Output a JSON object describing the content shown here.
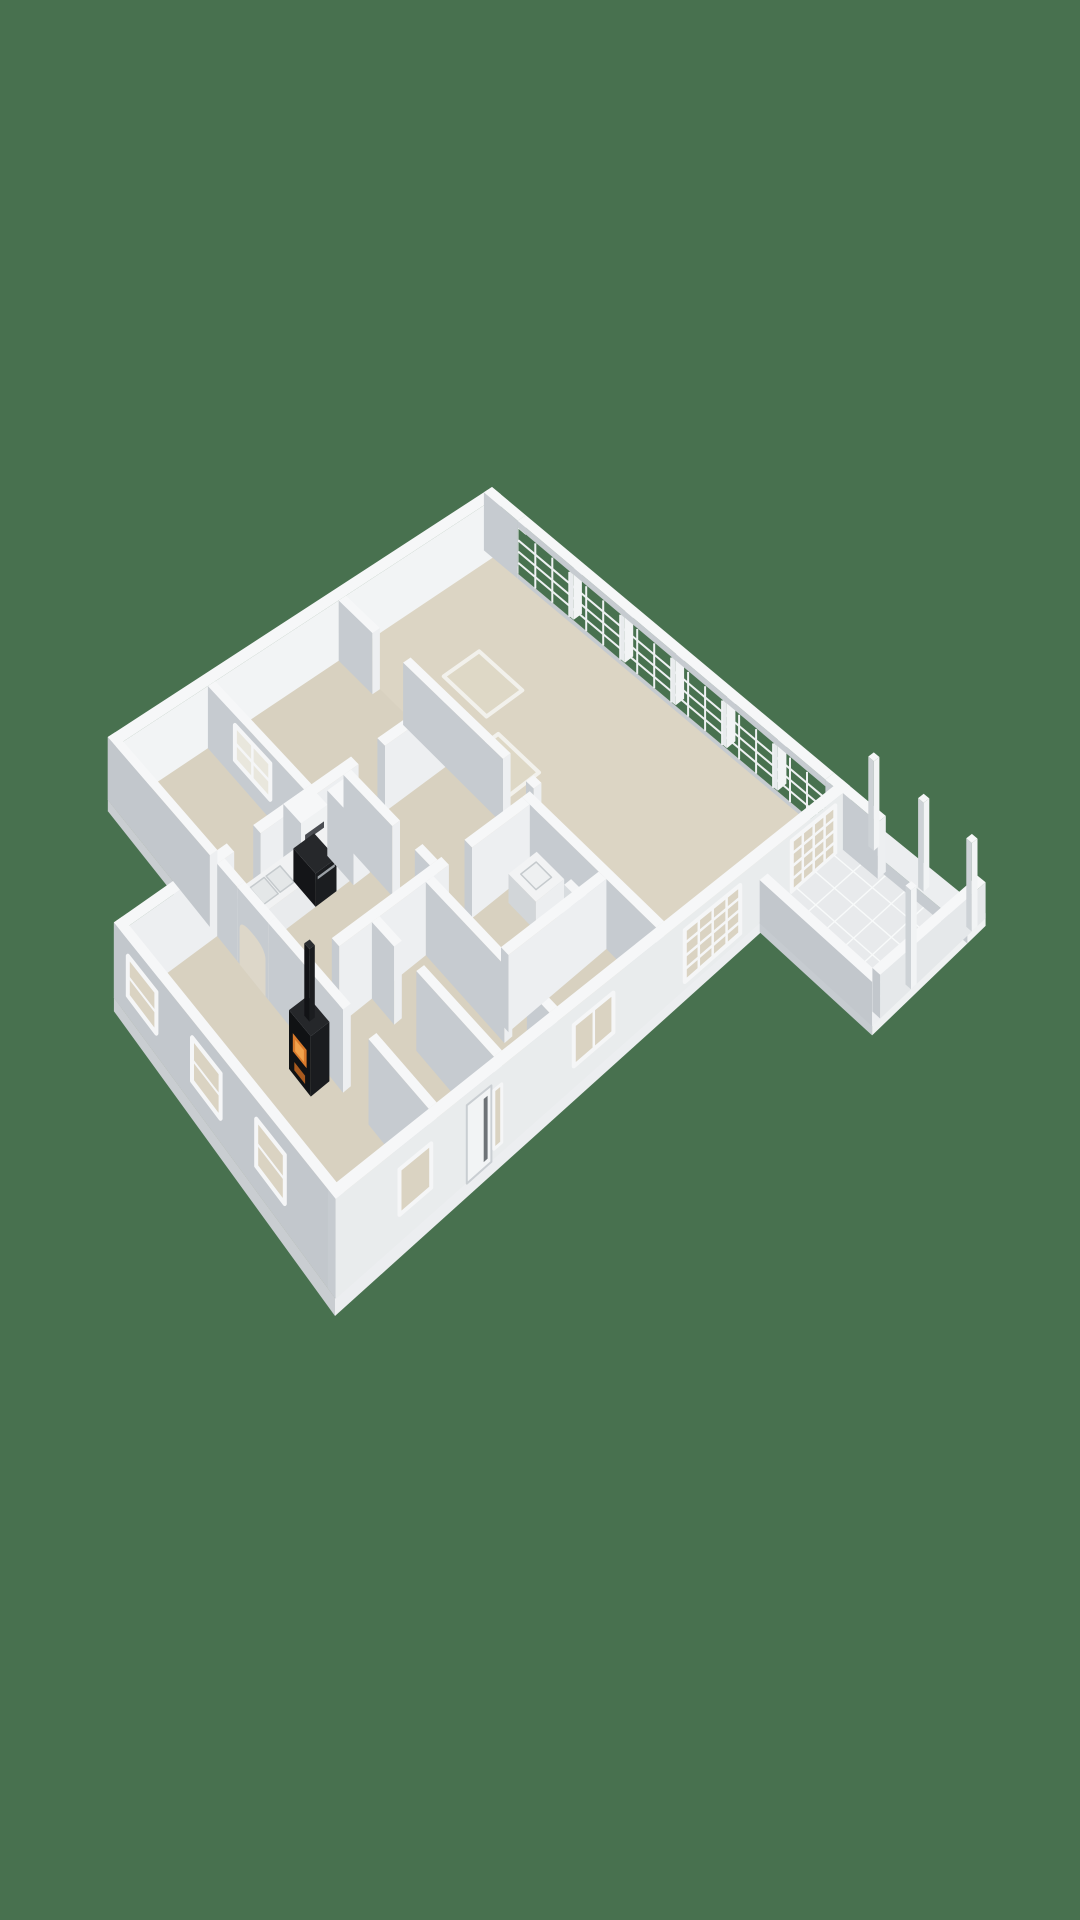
{
  "scene": {
    "kind": "3d-floor-plan-render",
    "background": "#48714f",
    "canvas": [
      1080,
      1920
    ]
  },
  "colors": {
    "background": "#48714f",
    "floor": "#d8d1c0",
    "floorGreat": "#dcd5c4",
    "wallTop": "#f6f7f8",
    "wallShade": "#c6cbd0",
    "wallLight": "#edeff1",
    "exteriorGrey": "#c2c7cc",
    "paneBeige": "#dad3c2",
    "glassOutside": "#48714f",
    "applianceDark": "#17181b",
    "fireOrange": "#d97a2b",
    "tile": "#e8eaec"
  },
  "projection": {
    "span": [
      13,
      9
    ],
    "corners": {
      "W": [
        14,
        862
      ],
      "N": [
        492,
        545
      ],
      "E": [
        850,
        842
      ],
      "S": [
        335,
        1298
      ]
    },
    "heights": {
      "W": 64,
      "N": 58,
      "E": 56,
      "S": 100
    }
  },
  "elements": [
    {
      "t": "prism",
      "n": "foundation-slab-main",
      "u1": 0,
      "v1": 2.8,
      "u2": 13,
      "v2": 9,
      "z1": -0.18,
      "z2": 0,
      "ct": "#d8d1c0",
      "cu": "#c9cdd1",
      "cv": "#eceef0"
    },
    {
      "t": "prism",
      "n": "foundation-slab-north",
      "u1": 2.55,
      "v1": 0,
      "u2": 13,
      "v2": 2.8,
      "z1": -0.18,
      "z2": 0,
      "ct": "#d8d1c0",
      "cu": "#c9cdd1",
      "cv": "#eceef0"
    },
    {
      "t": "rectZ",
      "n": "great-room-floor",
      "z": 0.004,
      "u1": 8.8,
      "v1": 0.22,
      "u2": 12.78,
      "v2": 8.8,
      "f": "#dcd5c4"
    },
    {
      "t": "rectZ",
      "n": "floor-hatch-a",
      "z": 0.006,
      "u1": 10.0,
      "v1": 1.6,
      "u2": 10.95,
      "v2": 2.7,
      "f": "#ded8c6",
      "s": "#f2f1ec",
      "w": 4
    },
    {
      "t": "rectZ",
      "n": "floor-hatch-b",
      "z": 0.006,
      "u1": 8.9,
      "v1": 3.1,
      "u2": 9.9,
      "v2": 4.15,
      "f": "#ded8c6",
      "s": "#f2f1ec",
      "w": 4
    },
    {
      "t": "rectZ",
      "n": "radiator-groove",
      "z": 0.004,
      "u1": 0.35,
      "v1": 8.45,
      "u2": 3.05,
      "v2": 8.72,
      "f": "#e6e4db",
      "s": "#c9c9c3",
      "w": 1.2
    },
    {
      "t": "prism",
      "n": "nw-facade-wall",
      "u1": 2.55,
      "v1": 0,
      "u2": 13,
      "v2": 0.22,
      "z1": 0,
      "z2": 1,
      "cu": "#c2c7cc",
      "cv": "#f2f4f5"
    },
    {
      "t": "prism",
      "n": "ne-corner-wall",
      "u1": 12.78,
      "v1": 0,
      "u2": 13,
      "v2": 0.85,
      "z1": 0,
      "z2": 1
    },
    {
      "t": "prism",
      "n": "window-wall-sill",
      "u1": 12.78,
      "v1": 0.85,
      "u2": 13,
      "v2": 8.6,
      "z1": 0,
      "z2": 0.1
    },
    {
      "t": "rectU",
      "n": "window-wall-glass",
      "u": 12.77,
      "v1": 0.88,
      "v2": 8.58,
      "z1": 0.1,
      "z2": 0.88,
      "f": "#48714f"
    },
    {
      "t": "gridU",
      "n": "window-wall-muntins",
      "u": 12.765,
      "v1": 0.88,
      "v2": 8.58,
      "z1": 0.1,
      "z2": 0.88,
      "cols": 18,
      "rows": 4,
      "s": "#eef1f2",
      "w": 2
    },
    {
      "t": "prism",
      "n": "window-wall-mullion-1",
      "u1": 12.78,
      "v1": 2.16,
      "u2": 13,
      "v2": 2.26,
      "z1": 0.1,
      "z2": 0.88,
      "cu": "#e8ebed",
      "cv": "#f2f4f5"
    },
    {
      "t": "prism",
      "n": "window-wall-mullion-2",
      "u1": 12.78,
      "v1": 3.45,
      "u2": 13,
      "v2": 3.55,
      "z1": 0.1,
      "z2": 0.88,
      "cu": "#e8ebed",
      "cv": "#f2f4f5"
    },
    {
      "t": "prism",
      "n": "window-wall-mullion-3",
      "u1": 12.78,
      "v1": 4.73,
      "u2": 13,
      "v2": 4.83,
      "z1": 0.1,
      "z2": 0.88,
      "cu": "#e8ebed",
      "cv": "#f2f4f5"
    },
    {
      "t": "prism",
      "n": "window-wall-mullion-4",
      "u1": 12.78,
      "v1": 6.02,
      "u2": 13,
      "v2": 6.12,
      "z1": 0.1,
      "z2": 0.88,
      "cu": "#e8ebed",
      "cv": "#f2f4f5"
    },
    {
      "t": "prism",
      "n": "window-wall-mullion-5",
      "u1": 12.78,
      "v1": 7.3,
      "u2": 13,
      "v2": 7.4,
      "z1": 0.1,
      "z2": 0.88,
      "cu": "#e8ebed",
      "cv": "#f2f4f5"
    },
    {
      "t": "prism",
      "n": "window-wall-header",
      "u1": 12.78,
      "v1": 0.85,
      "u2": 13,
      "v2": 8.6,
      "z1": 0.88,
      "z2": 1
    },
    {
      "t": "prism",
      "n": "ne-end-wall",
      "u1": 12.78,
      "v1": 8.6,
      "u2": 13,
      "v2": 9,
      "z1": 0,
      "z2": 1
    },
    {
      "t": "prism",
      "n": "bedroom-divider-wall",
      "u1": 5.05,
      "v1": 0.22,
      "u2": 5.25,
      "v2": 2.8,
      "z1": 0,
      "z2": 1
    },
    {
      "t": "rectU",
      "n": "interior-sash-window",
      "u": 5.045,
      "v1": 0.95,
      "v2": 1.9,
      "z1": 0.3,
      "z2": 0.85,
      "f": "#e9e7dd",
      "s": "#f5f6f7",
      "w": 4
    },
    {
      "t": "gridU",
      "n": "interior-sash-muntins",
      "u": 5.04,
      "v1": 0.95,
      "v2": 1.9,
      "z1": 0.3,
      "z2": 0.85,
      "cols": 2,
      "rows": 2,
      "s": "#f5f6f7",
      "w": 2.5
    },
    {
      "t": "prism",
      "n": "north-wall-seg-1",
      "u1": 0,
      "v1": 2.8,
      "u2": 3.0,
      "v2": 3.0,
      "z1": 0,
      "z2": 1
    },
    {
      "t": "prism",
      "n": "north-wall-seg-2",
      "u1": 3.7,
      "v1": 2.8,
      "u2": 6.3,
      "v2": 3.0,
      "z1": 0,
      "z2": 1
    },
    {
      "t": "prism",
      "n": "north-wall-seg-3",
      "u1": 7.0,
      "v1": 2.8,
      "u2": 8.6,
      "v2": 3.0,
      "z1": 0,
      "z2": 1
    },
    {
      "t": "prism",
      "n": "great-room-west-wall-1",
      "u1": 8.6,
      "v1": 0.22,
      "u2": 8.8,
      "v2": 1.1,
      "z1": 0,
      "z2": 1
    },
    {
      "t": "prism",
      "n": "great-room-west-wall-2",
      "u1": 8.6,
      "v1": 1.9,
      "u2": 8.8,
      "v2": 4.5,
      "z1": 0,
      "z2": 1
    },
    {
      "t": "prism",
      "n": "great-room-west-wall-3",
      "u1": 8.6,
      "v1": 5.1,
      "u2": 8.8,
      "v2": 5.3,
      "z1": 0,
      "z2": 1
    },
    {
      "t": "prism",
      "n": "range-hood-chimney",
      "u1": 4.5,
      "v1": 2.8,
      "u2": 5.2,
      "v2": 3.28,
      "z1": 0,
      "z2": 1,
      "cv": "#f0f2f3"
    },
    {
      "t": "rectV",
      "n": "hood-vent-slot",
      "v": 3.285,
      "u1": 4.6,
      "u2": 5.1,
      "z1": 0.62,
      "z2": 0.8,
      "f": "#4a4d52"
    },
    {
      "t": "prism",
      "n": "kitchen-counter",
      "u1": 2.95,
      "v1": 3.02,
      "u2": 4.55,
      "v2": 3.62,
      "z1": 0,
      "z2": 0.45,
      "ct": "#f1f2f3",
      "cu": "#ced3d6",
      "cv": "#e9ebed"
    },
    {
      "t": "prism",
      "n": "kitchen-counter-2",
      "u1": 5.1,
      "v1": 3.02,
      "u2": 5.45,
      "v2": 3.62,
      "z1": 0,
      "z2": 0.45,
      "ct": "#f1f2f3",
      "cu": "#ced3d6",
      "cv": "#e9ebed"
    },
    {
      "t": "rectZ",
      "n": "kitchen-sink-basin-1",
      "z": 0.455,
      "u1": 3.3,
      "v1": 3.12,
      "u2": 3.68,
      "v2": 3.5,
      "f": "#e4e7e8",
      "s": "#c5cacd",
      "w": 1.5
    },
    {
      "t": "rectZ",
      "n": "kitchen-sink-basin-2",
      "z": 0.455,
      "u1": 3.73,
      "v1": 3.12,
      "u2": 4.1,
      "v2": 3.5,
      "f": "#e4e7e8",
      "s": "#c5cacd",
      "w": 1.5
    },
    {
      "t": "prism",
      "n": "oven",
      "u1": 4.55,
      "v1": 3.02,
      "u2": 5.1,
      "v2": 3.62,
      "z1": 0,
      "z2": 0.47,
      "ct": "#26282b",
      "cu": "#141518",
      "cv": "#1b1d20"
    },
    {
      "t": "rectV",
      "n": "oven-handle",
      "v": 3.625,
      "u1": 4.6,
      "u2": 5.05,
      "z1": 0.37,
      "z2": 0.41,
      "f": "#9ba1a6"
    },
    {
      "t": "prism",
      "n": "kitchen-tall-cabinet",
      "u1": 5.45,
      "v1": 3.02,
      "u2": 5.88,
      "v2": 3.72,
      "z1": 0,
      "z2": 0.96
    },
    {
      "t": "prism",
      "n": "storage-wall-1",
      "u1": 5.9,
      "v1": 3.0,
      "u2": 6.1,
      "v2": 4.3,
      "z1": 0,
      "z2": 1
    },
    {
      "t": "prism",
      "n": "storage-wall-2",
      "u1": 5.9,
      "v1": 4.9,
      "u2": 6.1,
      "v2": 5.3,
      "z1": 0,
      "z2": 1
    },
    {
      "t": "prism",
      "n": "bath-east-wall",
      "u1": 8.3,
      "v1": 5.3,
      "u2": 8.5,
      "v2": 8.8,
      "z1": 0,
      "z2": 1
    },
    {
      "t": "prism",
      "n": "hall-south-wall-1",
      "u1": 3.35,
      "v1": 5.3,
      "u2": 6.2,
      "v2": 5.5,
      "z1": 0,
      "z2": 1
    },
    {
      "t": "prism",
      "n": "hall-south-wall-2",
      "u1": 6.8,
      "v1": 5.3,
      "u2": 8.3,
      "v2": 5.5,
      "z1": 0,
      "z2": 1
    },
    {
      "t": "prism",
      "n": "bath-vanity",
      "u1": 7.55,
      "v1": 5.7,
      "u2": 8.28,
      "v2": 6.42,
      "z1": 0,
      "z2": 0.42,
      "ct": "#f2f3f4",
      "cu": "#d2d6d9",
      "cv": "#eceef0"
    },
    {
      "t": "rectZ",
      "n": "bath-sink",
      "z": 0.425,
      "u1": 7.72,
      "v1": 5.85,
      "u2": 8.12,
      "v2": 6.25,
      "f": "#eef0f1",
      "s": "#c5cacd",
      "w": 1.5
    },
    {
      "t": "prism",
      "n": "toilet",
      "u1": 7.9,
      "v1": 6.6,
      "u2": 8.28,
      "v2": 7.05,
      "z1": 0,
      "z2": 0.3,
      "ct": "#f4f5f6",
      "cu": "#d8dcdf",
      "cv": "#eef0f2"
    },
    {
      "t": "prism",
      "n": "toilet-tank",
      "u1": 8.1,
      "v1": 6.6,
      "u2": 8.28,
      "v2": 7.05,
      "z1": 0.3,
      "z2": 0.52,
      "ct": "#f4f5f6",
      "cu": "#d8dcdf",
      "cv": "#eef0f2"
    },
    {
      "t": "prism",
      "n": "bath-west-wall-1",
      "u1": 5.6,
      "v1": 5.5,
      "u2": 5.8,
      "v2": 7.6,
      "z1": 0,
      "z2": 1
    },
    {
      "t": "prism",
      "n": "bath-west-wall-2",
      "u1": 5.6,
      "v1": 8.2,
      "u2": 5.8,
      "v2": 8.8,
      "z1": 0,
      "z2": 1
    },
    {
      "t": "prism",
      "n": "bedroom-se-north-wall",
      "u1": 5.8,
      "v1": 7.3,
      "u2": 8.3,
      "v2": 7.5,
      "z1": 0,
      "z2": 1
    },
    {
      "t": "prism",
      "n": "hall-east-wall-1",
      "u1": 4.2,
      "v1": 5.5,
      "u2": 4.4,
      "v2": 6.1,
      "z1": 0,
      "z2": 1
    },
    {
      "t": "prism",
      "n": "hall-east-wall-2",
      "u1": 4.2,
      "v1": 6.7,
      "u2": 4.4,
      "v2": 8.8,
      "z1": 0,
      "z2": 1
    },
    {
      "t": "prism",
      "n": "strip-west-wall",
      "u1": 2.55,
      "v1": 0,
      "u2": 2.75,
      "v2": 2.8,
      "z1": 0,
      "z2": 1,
      "cu": "#c2c7cc"
    },
    {
      "t": "prism",
      "n": "arch-wall-1",
      "u1": 2.55,
      "v1": 3.0,
      "u2": 2.75,
      "v2": 3.55,
      "z1": 0,
      "z2": 1
    },
    {
      "t": "prism",
      "n": "arch-wall-2",
      "u1": 2.55,
      "v1": 3.55,
      "u2": 2.75,
      "v2": 4.4,
      "z1": 0,
      "z2": 1
    },
    {
      "t": "archU",
      "n": "arched-opening",
      "u": 2.545,
      "v1": 3.62,
      "v2": 4.33,
      "zTop": 0.62,
      "rise": 0.14,
      "f": "#ddd7c9"
    },
    {
      "t": "prism",
      "n": "arch-wall-3",
      "u1": 2.55,
      "v1": 4.4,
      "u2": 2.75,
      "v2": 5.35,
      "z1": 0,
      "z2": 1
    },
    {
      "t": "prism",
      "n": "stove-back-wall",
      "u1": 2.55,
      "v1": 5.35,
      "u2": 2.75,
      "v2": 6.45,
      "z1": 0,
      "z2": 1
    },
    {
      "t": "prism",
      "n": "arch-wall-4",
      "u1": 2.55,
      "v1": 7.15,
      "u2": 2.75,
      "v2": 8.8,
      "z1": 0,
      "z2": 1
    },
    {
      "t": "prism",
      "n": "wood-stove",
      "u1": 2.0,
      "v1": 5.55,
      "u2": 2.48,
      "v2": 6.15,
      "z1": 0,
      "z2": 0.72,
      "ct": "#25272a",
      "cu": "#101214",
      "cv": "#1a1c1f"
    },
    {
      "t": "rectU",
      "n": "stove-fire-window",
      "u": 1.995,
      "v1": 5.66,
      "v2": 6.04,
      "z1": 0.28,
      "z2": 0.5,
      "f": "#d97a2b"
    },
    {
      "t": "rectU",
      "n": "stove-fire-glow",
      "u": 1.99,
      "v1": 5.73,
      "v2": 5.97,
      "z1": 0.32,
      "z2": 0.46,
      "f": "#f1a24c"
    },
    {
      "t": "rectU",
      "n": "stove-ember-drawer",
      "u": 1.995,
      "v1": 5.7,
      "v2": 6.0,
      "z1": 0.07,
      "z2": 0.17,
      "f": "#a85a1e"
    },
    {
      "t": "prism",
      "n": "stove-flue-pipe",
      "u1": 2.17,
      "v1": 5.79,
      "u2": 2.31,
      "v2": 5.93,
      "z1": 0.72,
      "z2": 1.6,
      "ct": "#2a2c2f",
      "cu": "#121316",
      "cv": "#1b1d20"
    },
    {
      "t": "prism",
      "n": "sw-facade-wall",
      "u1": 0,
      "v1": 2.8,
      "u2": 0.22,
      "v2": 9,
      "z1": 0,
      "z2": 1,
      "cu": "#c2c7cc"
    },
    {
      "t": "rectU",
      "n": "sw-window-1",
      "u": -0.008,
      "v1": 3.2,
      "v2": 4.0,
      "z1": 0.28,
      "z2": 0.8,
      "f": "#dad3c2",
      "s": "#f5f6f7",
      "w": 4
    },
    {
      "t": "gridU",
      "n": "sw-window-1-bar",
      "u": -0.012,
      "v1": 3.2,
      "v2": 4.0,
      "z1": 0.28,
      "z2": 0.8,
      "cols": 1,
      "rows": 2,
      "s": "#f5f6f7",
      "w": 2
    },
    {
      "t": "rectU",
      "n": "sw-window-2",
      "u": -0.008,
      "v1": 5.0,
      "v2": 5.8,
      "z1": 0.28,
      "z2": 0.8,
      "f": "#dad3c2",
      "s": "#f5f6f7",
      "w": 4
    },
    {
      "t": "gridU",
      "n": "sw-window-2-bar",
      "u": -0.012,
      "v1": 5.0,
      "v2": 5.8,
      "z1": 0.28,
      "z2": 0.8,
      "cols": 1,
      "rows": 2,
      "s": "#f5f6f7",
      "w": 2
    },
    {
      "t": "rectU",
      "n": "sw-window-3",
      "u": -0.008,
      "v1": 6.8,
      "v2": 7.6,
      "z1": 0.28,
      "z2": 0.8,
      "f": "#dad3c2",
      "s": "#f5f6f7",
      "w": 4
    },
    {
      "t": "gridU",
      "n": "sw-window-3-bar",
      "u": -0.012,
      "v1": 6.8,
      "v2": 7.6,
      "z1": 0.28,
      "z2": 0.8,
      "cols": 1,
      "rows": 2,
      "s": "#f5f6f7",
      "w": 2
    },
    {
      "t": "prism",
      "n": "se-facade-wall",
      "u1": 0,
      "v1": 8.8,
      "u2": 13,
      "v2": 9.02,
      "z1": 0,
      "z2": 1,
      "cv": "#e9eced"
    },
    {
      "t": "rectV",
      "n": "se-window-lounge",
      "v": 9.03,
      "u1": 1.6,
      "u2": 2.4,
      "z1": 0.3,
      "z2": 0.78,
      "f": "#dad3c2",
      "s": "#f5f6f7",
      "w": 4
    },
    {
      "t": "rectV",
      "n": "entry-door",
      "v": 9.03,
      "u1": 3.3,
      "u2": 3.92,
      "z1": 0,
      "z2": 0.88,
      "f": "#f2f4f5",
      "s": "#c9ced2",
      "w": 2
    },
    {
      "t": "rectV",
      "n": "entry-door-glass",
      "v": 9.035,
      "u1": 3.72,
      "u2": 3.82,
      "z1": 0.08,
      "z2": 0.8,
      "f": "#6e7377"
    },
    {
      "t": "rectV",
      "n": "entry-sidelight",
      "v": 9.03,
      "u1": 3.98,
      "u2": 4.18,
      "z1": 0.12,
      "z2": 0.8,
      "f": "#dad3c2",
      "s": "#f5f6f7",
      "w": 3
    },
    {
      "t": "rectV",
      "n": "se-window-bedroom",
      "v": 9.03,
      "u1": 6.0,
      "u2": 7.0,
      "z1": 0.28,
      "z2": 0.8,
      "f": "#dad3c2",
      "s": "#f5f6f7",
      "w": 4
    },
    {
      "t": "gridV",
      "n": "se-window-bedroom-bar",
      "v": 9.035,
      "u1": 6.0,
      "u2": 7.0,
      "z1": 0.28,
      "z2": 0.8,
      "cols": 2,
      "rows": 1,
      "s": "#f5f6f7",
      "w": 2.5
    },
    {
      "t": "rectV",
      "n": "se-grid-window",
      "v": 9.03,
      "u1": 8.8,
      "u2": 10.2,
      "z1": 0.12,
      "z2": 0.86,
      "f": "#dad3c2",
      "s": "#f5f6f7",
      "w": 4
    },
    {
      "t": "gridV",
      "n": "se-grid-window-muntins",
      "v": 9.035,
      "u1": 8.8,
      "u2": 10.2,
      "z1": 0.12,
      "z2": 0.86,
      "cols": 4,
      "rows": 4,
      "s": "#f5f6f7",
      "w": 2.5
    },
    {
      "t": "rectV",
      "n": "terrace-glass-doors",
      "v": 9.03,
      "u1": 11.5,
      "u2": 12.6,
      "z1": 0.06,
      "z2": 0.9,
      "f": "#dad3c2",
      "s": "#f5f6f7",
      "w": 4
    },
    {
      "t": "gridV",
      "n": "terrace-glass-doors-muntins",
      "v": 9.035,
      "u1": 11.5,
      "u2": 12.6,
      "z1": 0.06,
      "z2": 0.9,
      "cols": 4,
      "rows": 4,
      "s": "#f5f6f7",
      "w": 2.5
    },
    {
      "t": "prism",
      "n": "terrace-floor",
      "u1": 10.7,
      "v1": 9.02,
      "u2": 13.05,
      "v2": 11.9,
      "z1": -0.14,
      "z2": 0.02,
      "ct": "#e8eaec",
      "cu": "#c6cbd0",
      "cv": "#eff1f2"
    },
    {
      "t": "gridZ",
      "n": "terrace-tile-joints",
      "z": 0.035,
      "u1": 10.7,
      "v1": 9.02,
      "u2": 13.05,
      "v2": 11.9,
      "cols": 5,
      "rows": 6,
      "s": "#f8fafa",
      "w": 1.4
    },
    {
      "t": "prism",
      "n": "terrace-ledge",
      "u1": 13.05,
      "v1": 9.02,
      "u2": 13.5,
      "v2": 11.9,
      "z1": -0.14,
      "z2": 0.1,
      "ct": "#eceef0",
      "cu": "#c6cbd0",
      "cv": "#f0f2f3"
    },
    {
      "t": "prism",
      "n": "terrace-parapet-sw",
      "u1": 10.7,
      "v1": 9.02,
      "u2": 10.9,
      "v2": 11.9,
      "z1": 0,
      "z2": 0.68,
      "cu": "#c2c7cc"
    },
    {
      "t": "prism",
      "n": "terrace-parapet-se",
      "u1": 10.9,
      "v1": 11.7,
      "u2": 13.5,
      "v2": 11.9,
      "z1": 0,
      "z2": 0.68,
      "cu": "#c2c7cc",
      "cv": "#e5e8ea"
    },
    {
      "t": "prism",
      "n": "terrace-screen-wall",
      "u1": 12.8,
      "v1": 9.02,
      "u2": 13.0,
      "v2": 9.9,
      "z1": 0,
      "z2": 1
    },
    {
      "t": "prism",
      "n": "pergola-post-1",
      "u1": 13.16,
      "v1": 9.3,
      "u2": 13.3,
      "v2": 9.44,
      "z1": 0,
      "z2": 1.62,
      "cu": "#cdd2d6",
      "cv": "#f2f4f5"
    },
    {
      "t": "prism",
      "n": "pergola-post-2",
      "u1": 13.16,
      "v1": 10.55,
      "u2": 13.3,
      "v2": 10.69,
      "z1": 0,
      "z2": 1.62,
      "cu": "#cdd2d6",
      "cv": "#f2f4f5"
    },
    {
      "t": "prism",
      "n": "pergola-post-3",
      "u1": 13.16,
      "v1": 11.76,
      "u2": 13.3,
      "v2": 11.9,
      "z1": 0,
      "z2": 1.62,
      "cu": "#cdd2d6",
      "cv": "#f2f4f5"
    },
    {
      "t": "prism",
      "n": "pergola-post-4",
      "u1": 11.66,
      "v1": 11.76,
      "u2": 11.8,
      "v2": 11.9,
      "z1": 0,
      "z2": 1.62,
      "cu": "#cdd2d6",
      "cv": "#f2f4f5"
    }
  ]
}
